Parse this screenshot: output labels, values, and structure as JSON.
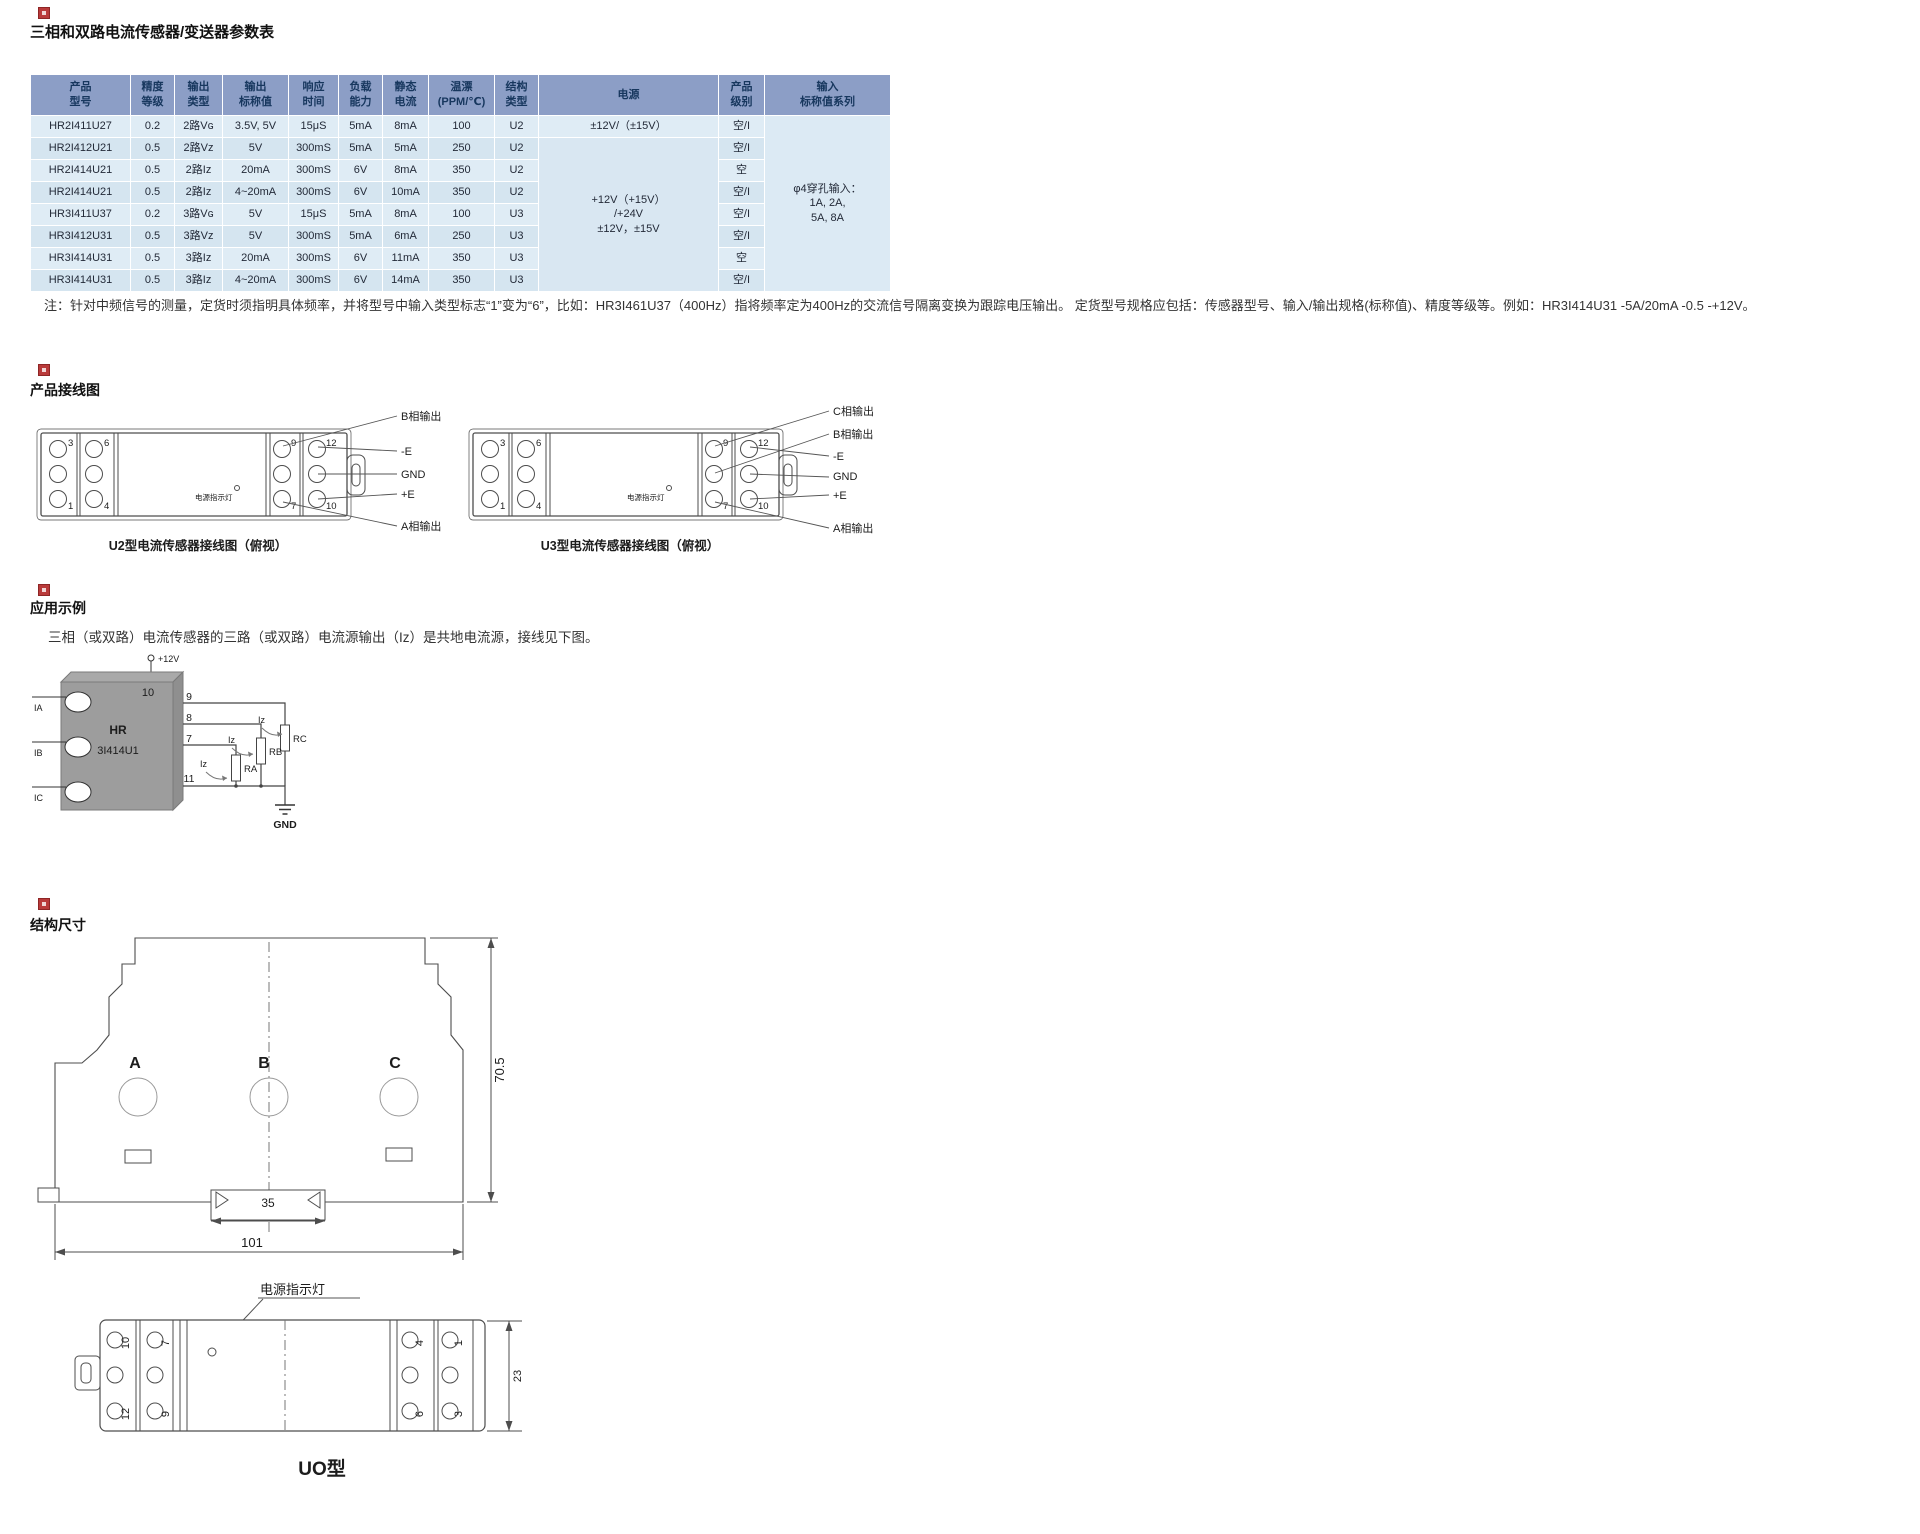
{
  "title": "三相和双路电流传感器/变送器参数表",
  "spec_table": {
    "headers": [
      "产品\n型号",
      "精度\n等级",
      "输出\n类型",
      "输出\n标称值",
      "响应\n时间",
      "负载\n能力",
      "静态\n电流",
      "温漂\n(PPM/℃)",
      "结构\n类型",
      "电源",
      "产品\n级别",
      "输入\n标称值系列"
    ],
    "rows": [
      [
        "HR2I411U27",
        "0.2",
        "2路Vɢ",
        "3.5V, 5V",
        "15μS",
        "5mA",
        "8mA",
        "100",
        "U2",
        "±12V/（±15V）",
        "空/I",
        {
          "t": "φ4穿孔输入：\n1A, 2A,\n5A, 8A",
          "rs": 8,
          "cls": "cell-input"
        }
      ],
      [
        "HR2I412U21",
        "0.5",
        "2路Vz",
        "5V",
        "300mS",
        "5mA",
        "5mA",
        "250",
        "U2",
        {
          "t": "+12V（+15V）\n/+24V\n±12V，±15V",
          "rs": 7,
          "cls": "cell-power"
        },
        "空/I"
      ],
      [
        "HR2I414U21",
        "0.5",
        "2路Iz",
        "20mA",
        "300mS",
        "6V",
        "8mA",
        "350",
        "U2",
        "空"
      ],
      [
        "HR2I414U21",
        "0.5",
        "2路Iz",
        "4~20mA",
        "300mS",
        "6V",
        "10mA",
        "350",
        "U2",
        "空/I"
      ],
      [
        "HR3I411U37",
        "0.2",
        "3路Vɢ",
        "5V",
        "15μS",
        "5mA",
        "8mA",
        "100",
        "U3",
        "空/I"
      ],
      [
        "HR3I412U31",
        "0.5",
        "3路Vz",
        "5V",
        "300mS",
        "5mA",
        "6mA",
        "250",
        "U3",
        "空/I"
      ],
      [
        "HR3I414U31",
        "0.5",
        "3路Iz",
        "20mA",
        "300mS",
        "6V",
        "11mA",
        "350",
        "U3",
        "空"
      ],
      [
        "HR3I414U31",
        "0.5",
        "3路Iz",
        "4~20mA",
        "300mS",
        "6V",
        "14mA",
        "350",
        "U3",
        "空/I"
      ]
    ]
  },
  "note": "注：针对中频信号的测量，定货时须指明具体频率，并将型号中输入类型标志“1”变为“6”，比如：HR3I461U37（400Hz）指将频率定为400Hz的交流信号隔离变换为跟踪电压输出。 定货型号规格应包括：传感器型号、输入/输出规格(标称值)、精度等级等。例如：HR3I414U31 -5A/20mA -0.5 -+12V。",
  "wiring": {
    "heading": "产品接线图",
    "indicator": "电源指示灯",
    "terminals": [
      "3",
      "6",
      "1",
      "4",
      "9",
      "12",
      "7",
      "10"
    ],
    "u2": {
      "caption": "U2型电流传感器接线图（俯视）",
      "labels": [
        "B相输出",
        "-E",
        "GND",
        "+E",
        "A相输出"
      ]
    },
    "u3": {
      "caption": "U3型电流传感器接线图（俯视）",
      "labels": [
        "C相输出",
        "B相输出",
        "-E",
        "GND",
        "+E",
        "A相输出"
      ]
    }
  },
  "application": {
    "heading": "应用示例",
    "description": "三相（或双路）电流传感器的三路（或双路）电流源输出（Iz）是共地电流源，接线见下图。",
    "circuit": {
      "supply": "+12V",
      "pin_top": "10",
      "pins": [
        "9",
        "8",
        "7",
        "11"
      ],
      "chip": [
        "HR",
        "3I414U1"
      ],
      "inputs": [
        "IA",
        "IB",
        "IC"
      ],
      "currents": [
        "Iz",
        "Iz",
        "Iz"
      ],
      "resistors": [
        "RA",
        "RB",
        "RC"
      ],
      "ground": "GND"
    }
  },
  "dimensions": {
    "heading": "结构尺寸",
    "front": {
      "labels": [
        "A",
        "B",
        "C"
      ],
      "dim_inner_width": "35",
      "dim_total_width": "101",
      "dim_height": "70.5"
    },
    "bottom": {
      "indicator_label": "电源指示灯",
      "terminals": [
        "10",
        "12",
        "7",
        "9",
        "4",
        "6",
        "1",
        "3"
      ],
      "dim_height": "23",
      "caption": "UO型"
    }
  }
}
